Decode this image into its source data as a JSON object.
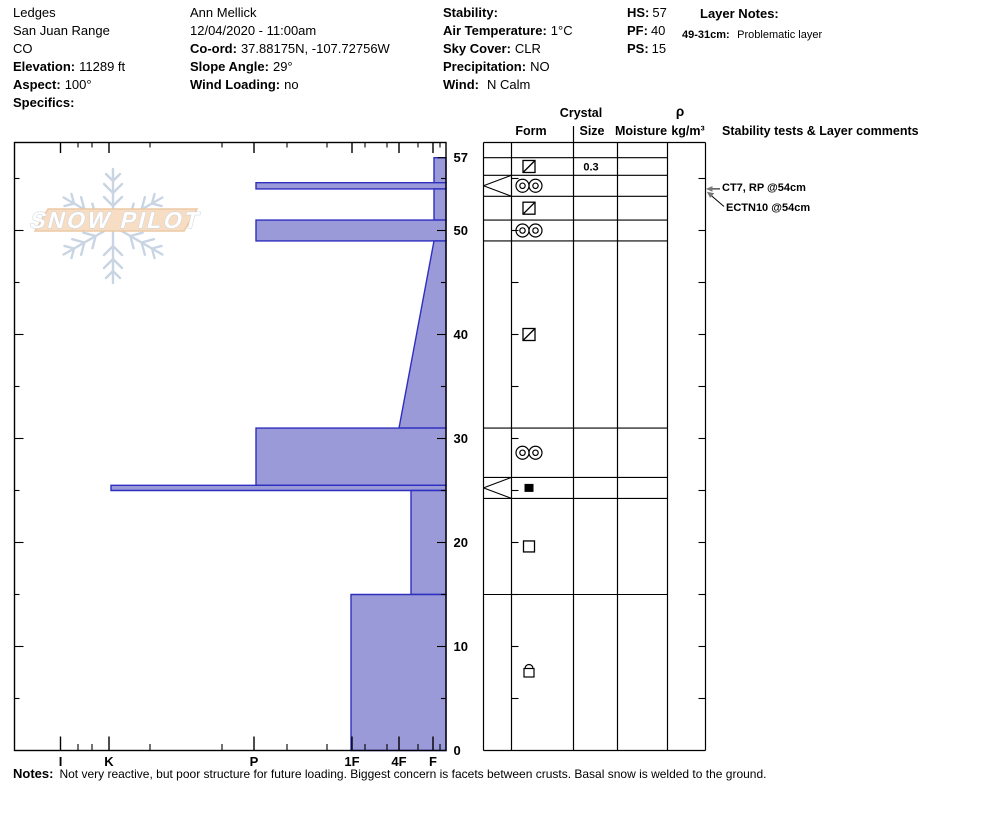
{
  "site": {
    "pit_name": "Ledges",
    "range": "San Juan Range",
    "state": "CO",
    "elevation_label": "Elevation:",
    "elevation": "11289 ft",
    "aspect_label": "Aspect:",
    "aspect": "100°",
    "specifics_label": "Specifics:"
  },
  "observer": {
    "name": "Ann Mellick",
    "datetime": "12/04/2020 - 11:00am",
    "coord_label": "Co-ord:",
    "coord": "37.88175N, -107.72756W",
    "slope_angle_label": "Slope Angle:",
    "slope_angle": "29°",
    "wind_loading_label": "Wind Loading:",
    "wind_loading": "no"
  },
  "conditions": {
    "stability_label": "Stability:",
    "stability": "",
    "air_temp_label": "Air Temperature:",
    "air_temp": "1°C",
    "sky_label": "Sky Cover:",
    "sky": "CLR",
    "precip_label": "Precipitation:",
    "precip": "NO",
    "wind_label": "Wind:",
    "wind": "N Calm"
  },
  "snowpack": {
    "hs_label": "HS:",
    "hs": "57",
    "pf_label": "PF:",
    "pf": "40",
    "ps_label": "PS:",
    "ps": "15"
  },
  "layer_notes": {
    "title": "Layer Notes:",
    "items": [
      {
        "range": "49-31cm:",
        "note": "Problematic layer"
      }
    ]
  },
  "watermark": {
    "line": "SNOW PILOT"
  },
  "table": {
    "crystal_header": "Crystal",
    "form_header": "Form",
    "size_header": "Size",
    "moisture_header": "Moisture",
    "density_header_top": "ρ",
    "density_header_bottom": "kg/m³",
    "comments_header": "Stability tests & Layer comments"
  },
  "chart_data": {
    "type": "bar",
    "title": "Snow pit hardness profile",
    "xlabel": "Hand hardness",
    "ylabel": "Depth (cm)",
    "depth_unit": "cm",
    "total_depth_cm": 57,
    "depth_axis_range": [
      0,
      57
    ],
    "hardness_ticks": [
      "I",
      "K",
      "P",
      "1F",
      "4F",
      "F"
    ],
    "depth_labels": [
      57,
      50,
      40,
      30,
      20,
      10,
      0
    ],
    "layers": [
      {
        "top": 57,
        "bottom": 54.6,
        "hardness": "F",
        "form": "melt-freeze-crust",
        "size": "0.3"
      },
      {
        "top": 54.6,
        "bottom": 54,
        "hardness": "P",
        "form": "melt-cluster"
      },
      {
        "top": 54,
        "bottom": 51,
        "hardness": "F",
        "form": "melt-freeze-crust"
      },
      {
        "top": 51,
        "bottom": 49,
        "hardness": "P",
        "form": "melt-cluster"
      },
      {
        "top": 49,
        "bottom": 31,
        "hardness": "F",
        "hardness_bottom": "4F",
        "form": "melt-freeze-crust"
      },
      {
        "top": 31,
        "bottom": 25.5,
        "hardness": "P",
        "form": "melt-cluster"
      },
      {
        "top": 25.5,
        "bottom": 25,
        "hardness": "K",
        "form": "ice"
      },
      {
        "top": 25,
        "bottom": 15,
        "hardness": "4F+",
        "form": "facets"
      },
      {
        "top": 15,
        "bottom": 0,
        "hardness": "1F",
        "form": "rounding-facets"
      }
    ],
    "stability_tests": [
      {
        "label": "CT7, RP @54cm",
        "depth": 54
      },
      {
        "label": "ECTN10 @54cm",
        "depth": 54
      }
    ],
    "colors": {
      "bar_fill": "#9a9ad8",
      "bar_border": "#2e2ec0",
      "banner": "#f7ddc3",
      "flake": "#c9d5e3"
    }
  },
  "notes": {
    "label": "Notes:",
    "text": "Not very reactive, but poor structure for future loading. Biggest concern is facets between crusts. Basal snow is welded to the ground."
  }
}
